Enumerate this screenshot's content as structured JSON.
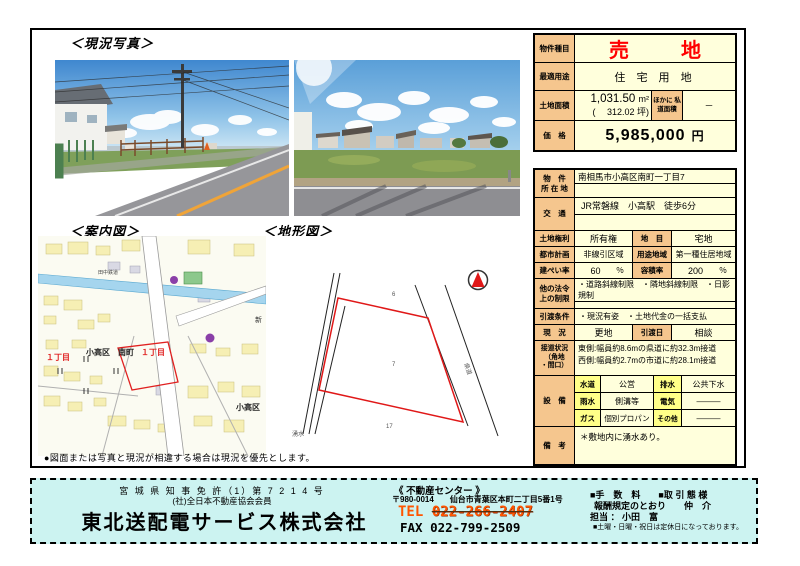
{
  "page": {
    "photo_section_label": "＜現況写真＞",
    "guide_map_label": "＜案内図＞",
    "plot_map_label": "＜地形図＞",
    "note": "●図面または写真と現況が相違する場合は現況を優先とします。"
  },
  "colors": {
    "accent_red": "#ff0000",
    "label_bg": "#f5c68e",
    "value_bg": "#ffffdc",
    "sub_label_bg": "#ffff88",
    "footer_bg": "#ccf3f1",
    "tel_orange": "#ff5500",
    "property_outline": "#e02020"
  },
  "property_table": {
    "type_label": "物件種目",
    "type_value": "売　地",
    "use_label": "最適用途",
    "use_value": "住 宅 用 地",
    "area_label": "土地面積",
    "area_value": "1,031.50",
    "area_unit": "m²",
    "area_tsubo": "(　 312.02 坪)",
    "private_road_label": "ほかに 私道面積",
    "private_road_value": "－",
    "price_label": "価　格",
    "price_value": "5,985,000",
    "price_unit": "円"
  },
  "detail_table": {
    "location_label": "物　件\n所 在 地",
    "location_value": "南相馬市小高区南町一丁目7",
    "location_value2": "",
    "access_label": "交　通",
    "access_value": "JR常磐線　小高駅　徒歩6分",
    "access_value2": "",
    "land_right_label": "土地権利",
    "land_right_value": "所有権",
    "land_category_label": "地　目",
    "land_category_value": "宅地",
    "city_plan_label": "都市計画",
    "city_plan_value": "非線引区域",
    "zoning_label": "用途地域",
    "zoning_value": "第一種住居地域",
    "bcr_label": "建ぺい率",
    "bcr_value": "60",
    "bcr_unit": "％",
    "far_label": "容積率",
    "far_value": "200",
    "far_unit": "％",
    "law_label": "他の法令\n上の制限",
    "law_value": "・道路斜線制限　・隣地斜線制限　・日影規制",
    "law_value2": "",
    "handover_cond_label": "引渡条件",
    "handover_cond_value": "・現況有姿　・土地代金の一括支払",
    "current_label": "現　況",
    "current_value": "更地",
    "handover_date_label": "引渡日",
    "handover_date_value": "相談",
    "road_contact_label": "接道状況\n（角地\n・間口）",
    "road_contact_line1": "東側:幅員約8.6mの県道に約32.3m接道",
    "road_contact_line2": "西側:幅員約2.7mの市道に約28.1m接道",
    "facilities_label": "設　備",
    "water_label": "水道",
    "water_value": "公営",
    "drain_label": "排水",
    "drain_value": "公共下水",
    "rain_label": "雨水",
    "rain_value": "側溝等",
    "elec_label": "電気",
    "elec_value": "―――",
    "gas_label": "ガス",
    "gas_value": "個別プロパン",
    "other_label": "その他",
    "other_value": "―――",
    "remarks_label": "備　考",
    "remarks_value": "＊敷地内に湧水あり。"
  },
  "guide_map": {
    "label_tanaka": "田中鉄道",
    "label_shin": "新",
    "label_1chome_left": "１丁目",
    "label_minamimachi": "小高区　南町",
    "label_1chome": "１丁目",
    "label_odaka": "小高区"
  },
  "plot_map": {
    "lot6": "6",
    "lot7": "7",
    "lot17": "17",
    "road_label": "県道",
    "water_label": "湧水"
  },
  "footer": {
    "license1": "宮 城 県 知 事 免 許（1）第 7 2 1 4 号",
    "license2": "(社)全日本不動産協会会員",
    "company": "東北送配電サービス株式会社",
    "center": "《 不動産センター 》",
    "address": "〒980-0014　　仙台市青葉区本町二丁目5番1号",
    "tel_label": "TEL",
    "tel": "022-266-2407",
    "fax_label": "FAX",
    "fax": "022-799-2509",
    "fee_header": "■手　数　料　　■取 引 態 様",
    "fee_value": "報酬規定のとおり　　仲　介",
    "staff": "担当 ： 小田　富",
    "holiday": "■土曜・日曜・祝日は定休日になっております。"
  }
}
